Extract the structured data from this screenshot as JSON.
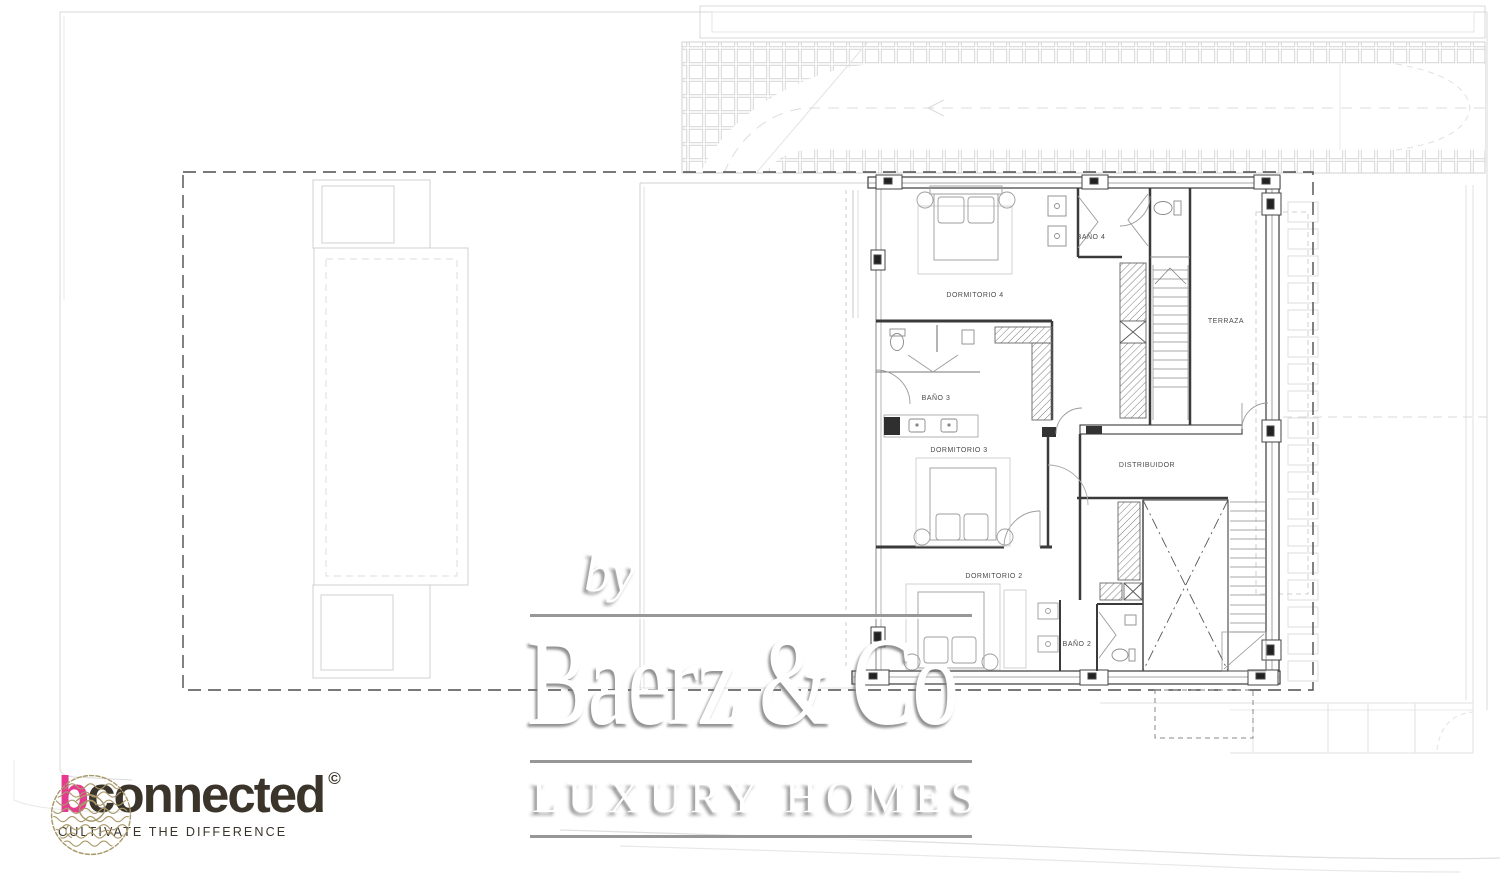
{
  "plan": {
    "room_labels": {
      "dormitorio4": "DORMITORIO 4",
      "bano4": "BAÑO 4",
      "terraza": "TERRAZA",
      "bano3": "BAÑO 3",
      "dormitorio3": "DORMITORIO 3",
      "distribuidor": "DISTRIBUIDOR",
      "dormitorio2": "DORMITORIO 2",
      "bano2": "BAÑO 2"
    }
  },
  "watermark": {
    "prefix": "by",
    "brand": "Baerz & Co",
    "tagline": "LUXURY HOMES"
  },
  "agency": {
    "brand_initial": "b",
    "brand_rest": "connected",
    "trademark": "©",
    "tagline": "CULTIVATE THE DIFFERENCE",
    "emblem_icon": "dragon-medallion",
    "colors": {
      "brand_initial": "#e6398f",
      "brand_text": "#3a342b",
      "emblem": "#a8996a"
    }
  }
}
